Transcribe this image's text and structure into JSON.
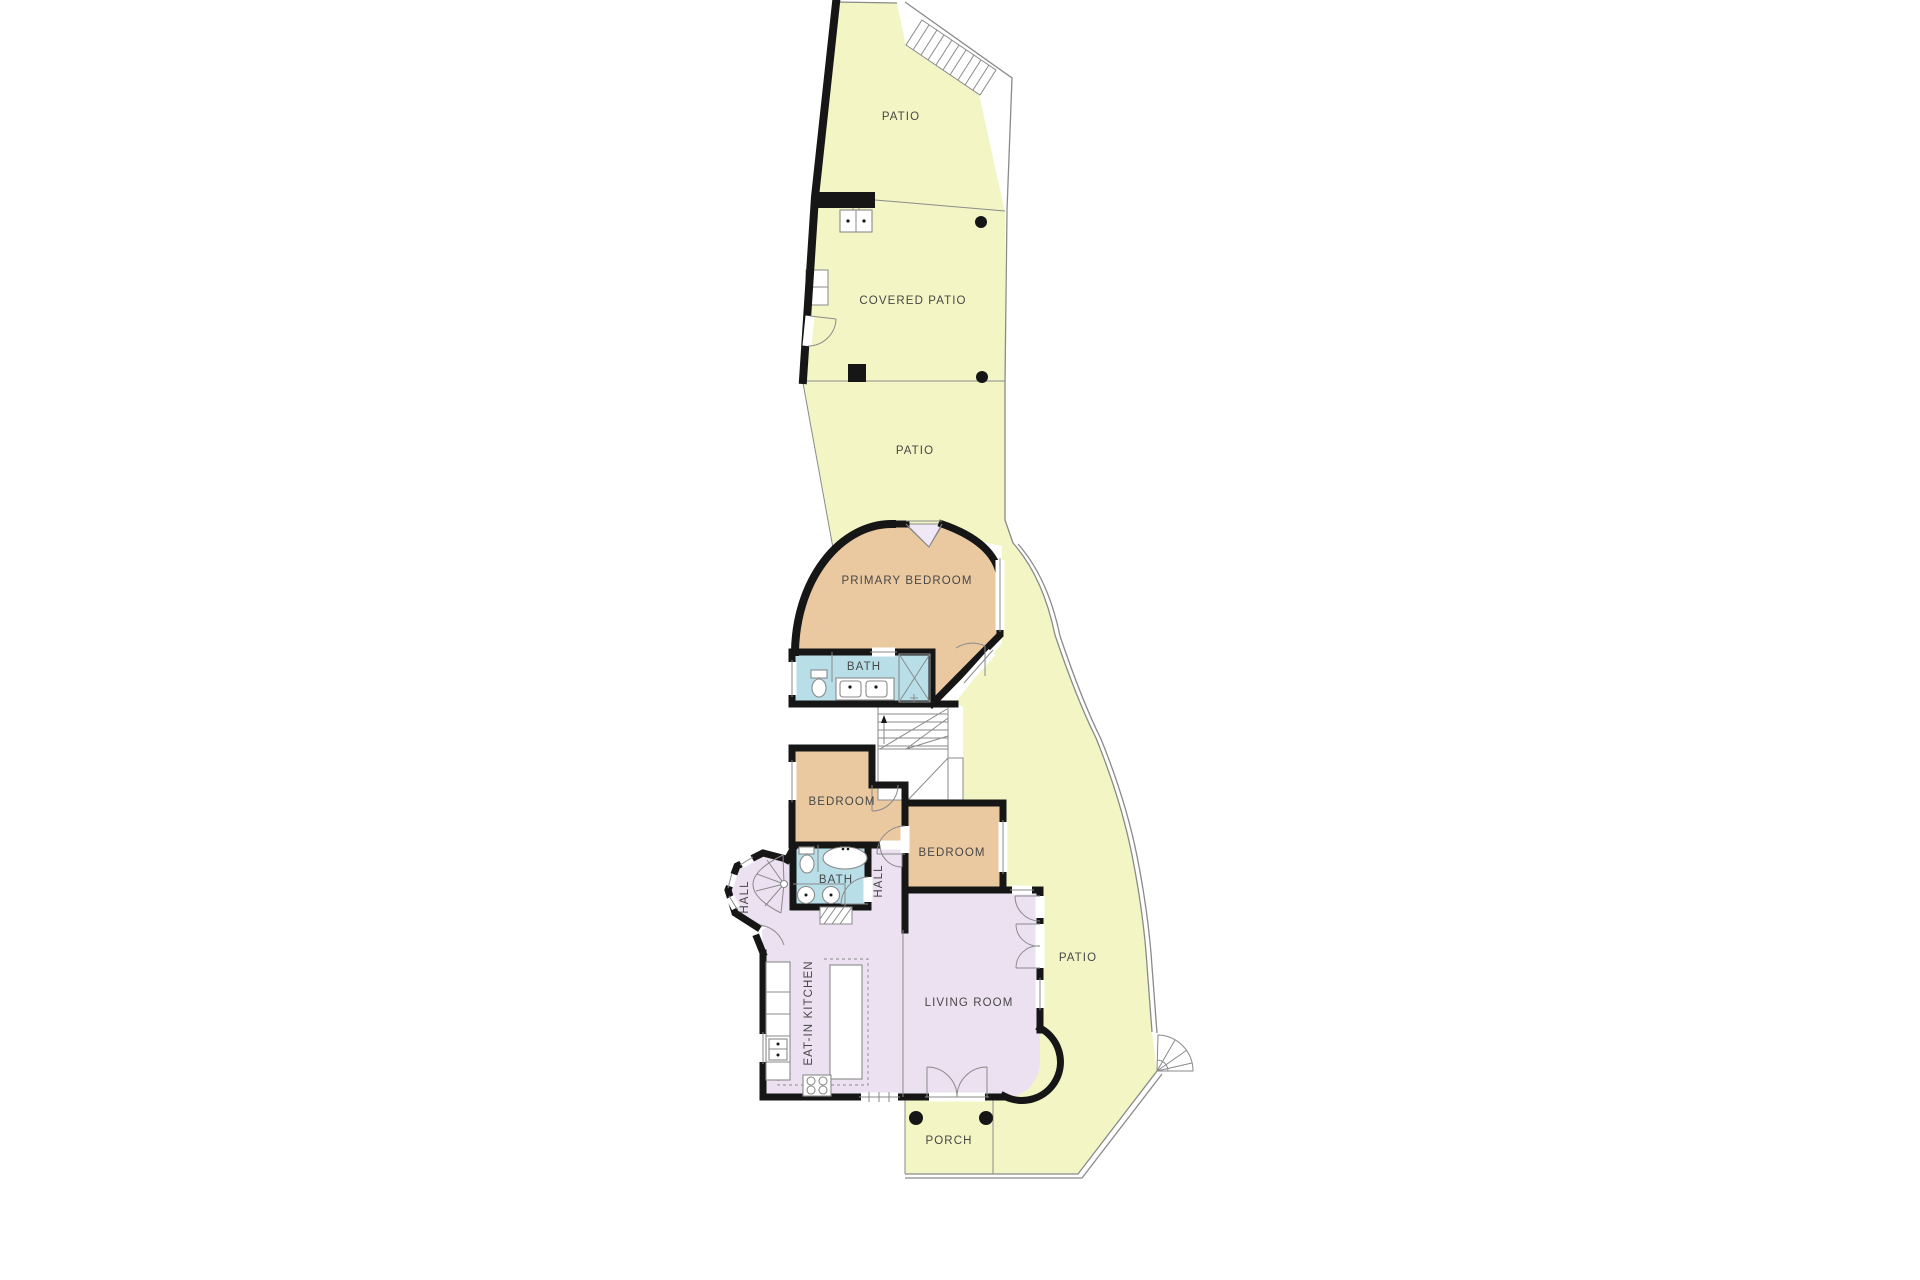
{
  "title": "Residential floor plan",
  "colors": {
    "patio": "#f3f6c4",
    "bedroom": "#ebc9a0",
    "bath": "#b8dfe8",
    "living": "#ebe1f1",
    "bay": "#f0e8f5",
    "wall": "#161616",
    "line": "#8a8a8a",
    "label": "#474747"
  },
  "rooms": {
    "patio_top": {
      "label": "PATIO"
    },
    "covered_patio": {
      "label": "COVERED PATIO"
    },
    "patio_middle": {
      "label": "PATIO"
    },
    "primary_bedroom": {
      "label": "PRIMARY BEDROOM"
    },
    "primary_bath": {
      "label": "BATH"
    },
    "bedroom_left": {
      "label": "BEDROOM"
    },
    "bedroom_right": {
      "label": "BEDROOM"
    },
    "hall_bath": {
      "label": "BATH"
    },
    "hall_upper": {
      "label": "HALL"
    },
    "hall_tower": {
      "label": "HALL"
    },
    "kitchen": {
      "label": "EAT-IN KITCHEN"
    },
    "living_room": {
      "label": "LIVING ROOM"
    },
    "patio_right": {
      "label": "PATIO"
    },
    "porch": {
      "label": "PORCH"
    }
  }
}
